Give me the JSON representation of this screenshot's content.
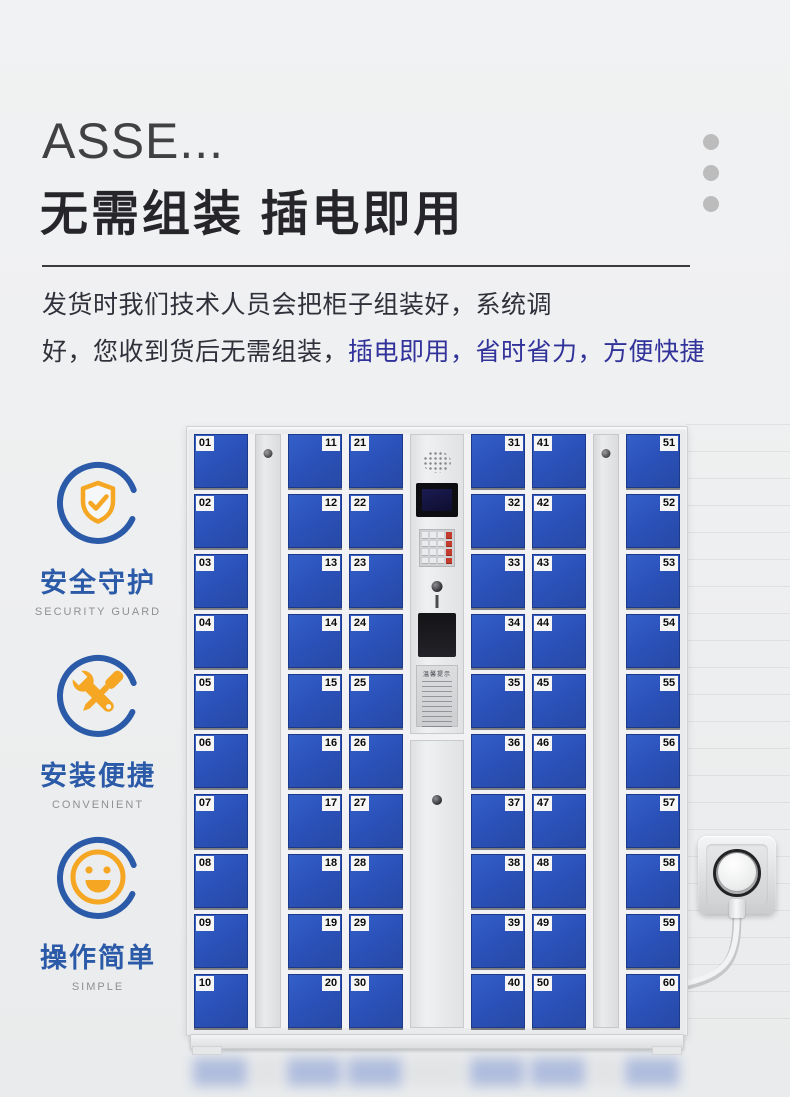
{
  "header": {
    "title_en": "ASSE...",
    "title_cn": "无需组装  插电即用"
  },
  "description": {
    "line1": "发货时我们技术人员会把柜子组装好，系统调",
    "line2_plain": "好，您收到货后无需组装，",
    "line2_highlight": "插电即用，省时省力，方便快捷"
  },
  "features": [
    {
      "icon": "shield-check-icon",
      "label": "安全守护",
      "sublabel": "SECURITY GUARD"
    },
    {
      "icon": "wrench-screwdriver-icon",
      "label": "安装便捷",
      "sublabel": "CONVENIENT"
    },
    {
      "icon": "smiley-icon",
      "label": "操作简单",
      "sublabel": "SIMPLE"
    }
  ],
  "locker": {
    "sticker_title": "温馨提示",
    "columns": [
      {
        "type": "doors",
        "label_side": "left",
        "numbers": [
          "01",
          "02",
          "03",
          "04",
          "05",
          "06",
          "07",
          "08",
          "09",
          "10"
        ]
      },
      {
        "type": "strip"
      },
      {
        "type": "doors",
        "label_side": "right",
        "numbers": [
          "11",
          "12",
          "13",
          "14",
          "15",
          "16",
          "17",
          "18",
          "19",
          "20"
        ]
      },
      {
        "type": "doors",
        "label_side": "left",
        "numbers": [
          "21",
          "22",
          "23",
          "24",
          "25",
          "26",
          "27",
          "28",
          "29",
          "30"
        ]
      },
      {
        "type": "control"
      },
      {
        "type": "doors",
        "label_side": "right",
        "numbers": [
          "31",
          "32",
          "33",
          "34",
          "35",
          "36",
          "37",
          "38",
          "39",
          "40"
        ]
      },
      {
        "type": "doors",
        "label_side": "left",
        "numbers": [
          "41",
          "42",
          "43",
          "44",
          "45",
          "46",
          "47",
          "48",
          "49",
          "50"
        ]
      },
      {
        "type": "strip"
      },
      {
        "type": "doors",
        "label_side": "right",
        "numbers": [
          "51",
          "52",
          "53",
          "54",
          "55",
          "56",
          "57",
          "58",
          "59",
          "60"
        ]
      }
    ]
  },
  "colors": {
    "door_blue": "#2b52ba",
    "accent_blue_text": "#32329b",
    "feature_blue": "#2b5aa8",
    "feature_orange": "#f5a623"
  }
}
